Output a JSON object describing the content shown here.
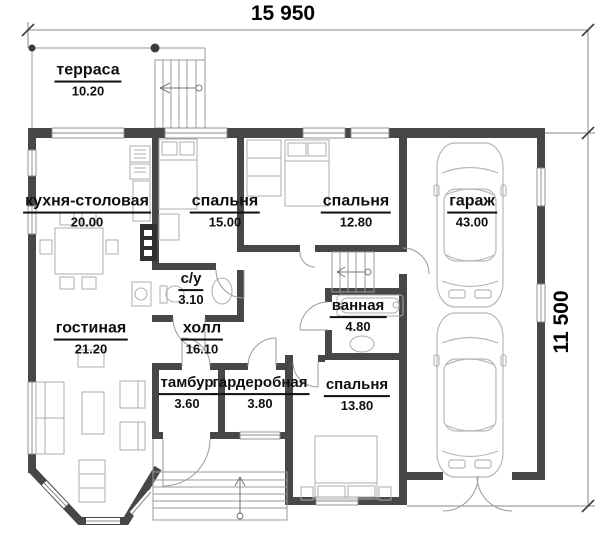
{
  "dimensions": {
    "width": "15 950",
    "height": "11 500"
  },
  "rooms": [
    {
      "id": "terrace",
      "name": "терраса",
      "area": "10.20"
    },
    {
      "id": "kitchen-dining",
      "name": "кухня-столовая",
      "area": "20.00"
    },
    {
      "id": "bedroom-1",
      "name": "спальня",
      "area": "15.00"
    },
    {
      "id": "bedroom-2",
      "name": "спальня",
      "area": "12.80"
    },
    {
      "id": "garage",
      "name": "гараж",
      "area": "43.00"
    },
    {
      "id": "wc",
      "name": "с/у",
      "area": "3.10"
    },
    {
      "id": "bathroom",
      "name": "ванная",
      "area": "4.80"
    },
    {
      "id": "living-room",
      "name": "гостиная",
      "area": "21.20"
    },
    {
      "id": "hall",
      "name": "холл",
      "area": "16.10"
    },
    {
      "id": "vestibule",
      "name": "тамбур",
      "area": "3.60"
    },
    {
      "id": "wardrobe",
      "name": "гардеробная",
      "area": "3.80"
    },
    {
      "id": "bedroom-3",
      "name": "спальня",
      "area": "13.80"
    }
  ]
}
